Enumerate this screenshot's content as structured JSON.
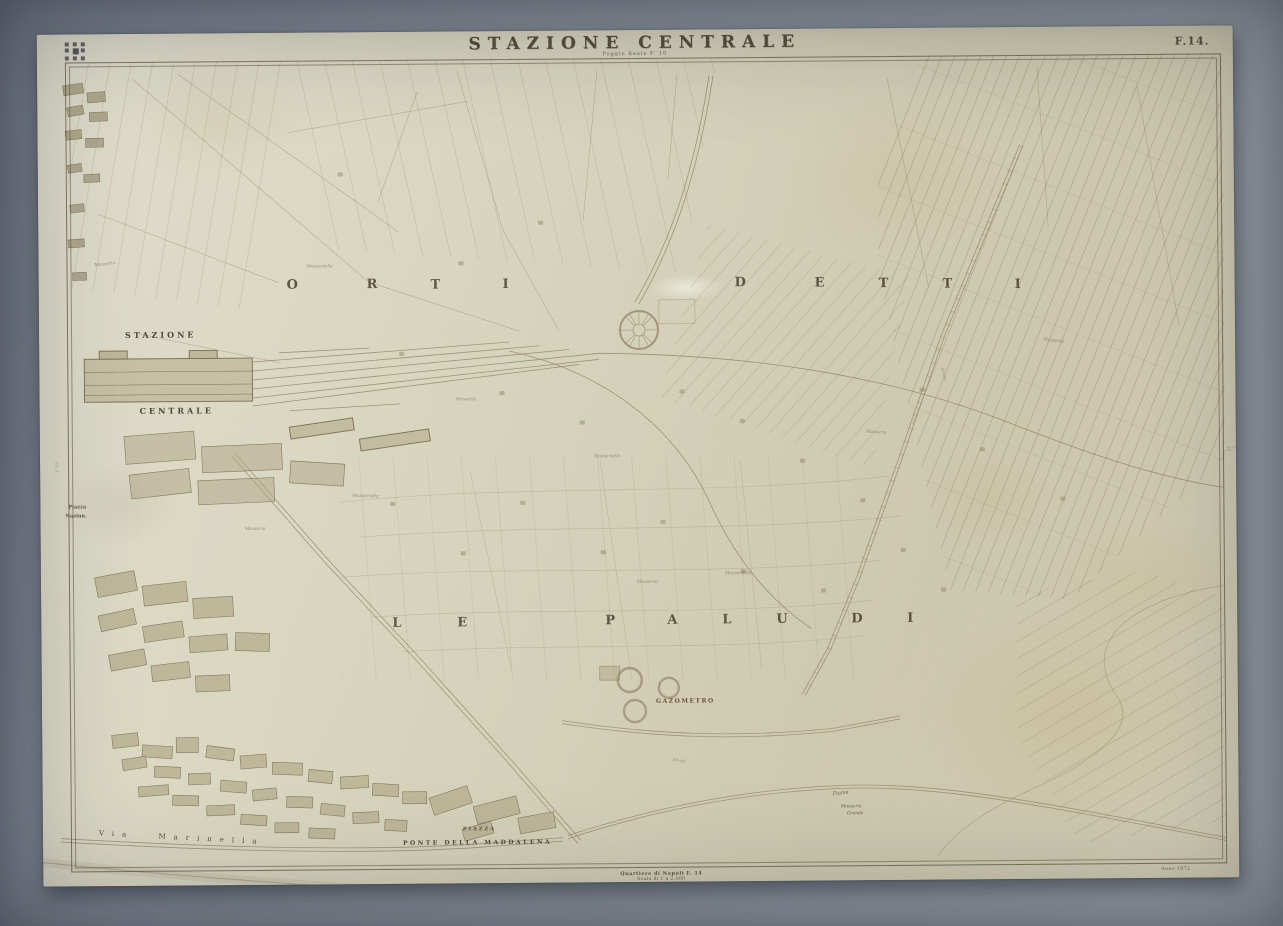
{
  "header": {
    "title": "STAZIONE CENTRALE",
    "subtitle": "Poggio Reale F. 10",
    "sheet_number": "F.14."
  },
  "margins": {
    "imprint_line1": "Quartiere di Napoli F. 14",
    "imprint_line2": "Scala di 1 a 2.000",
    "anno": "Anno 1872",
    "left_ref": "F. 13",
    "right_ref": "F. 15"
  },
  "districts": {
    "orti": [
      "O",
      "R",
      "T",
      "I"
    ],
    "detti": [
      "D",
      "E",
      "T",
      "T",
      "I"
    ],
    "le": [
      "L",
      "E"
    ],
    "paludi": [
      "P",
      "A",
      "L",
      "U",
      "D",
      "I"
    ]
  },
  "labels": {
    "stazione": "STAZIONE",
    "centrale": "CENTRALE",
    "gazometro": "GAZOMETRO",
    "piazza": "PIAZZA",
    "ponte_della_maddalena": "PONTE DELLA MADDALENA",
    "via_marinella": "Via Marinella",
    "piazza_nazionale_line1": "Piazza",
    "piazza_nazionale_line2": "Nazion.",
    "fiume": "Fiume",
    "masseria_grande_line1": "Masseria",
    "masseria_grande_line2": "Grande"
  },
  "farm_labels": [
    "Masserielle",
    "Masseria",
    "Masserielle",
    "Masseria",
    "Masseria",
    "Masserielle",
    "Masseria",
    "Masseria",
    "Masseria",
    "Masserielle"
  ],
  "road_labels": [
    "Strada",
    "Strada"
  ],
  "icons": {
    "corner_stamp": "archive-stamp-grid",
    "roundhouse": "engine-roundhouse",
    "gasometers": "gas-holder-circles"
  },
  "colors": {
    "paper": "#d8d5bf",
    "ink": "#8a7a5c",
    "lettering": "#564f3e",
    "photo_mat": "#8e96a0"
  }
}
